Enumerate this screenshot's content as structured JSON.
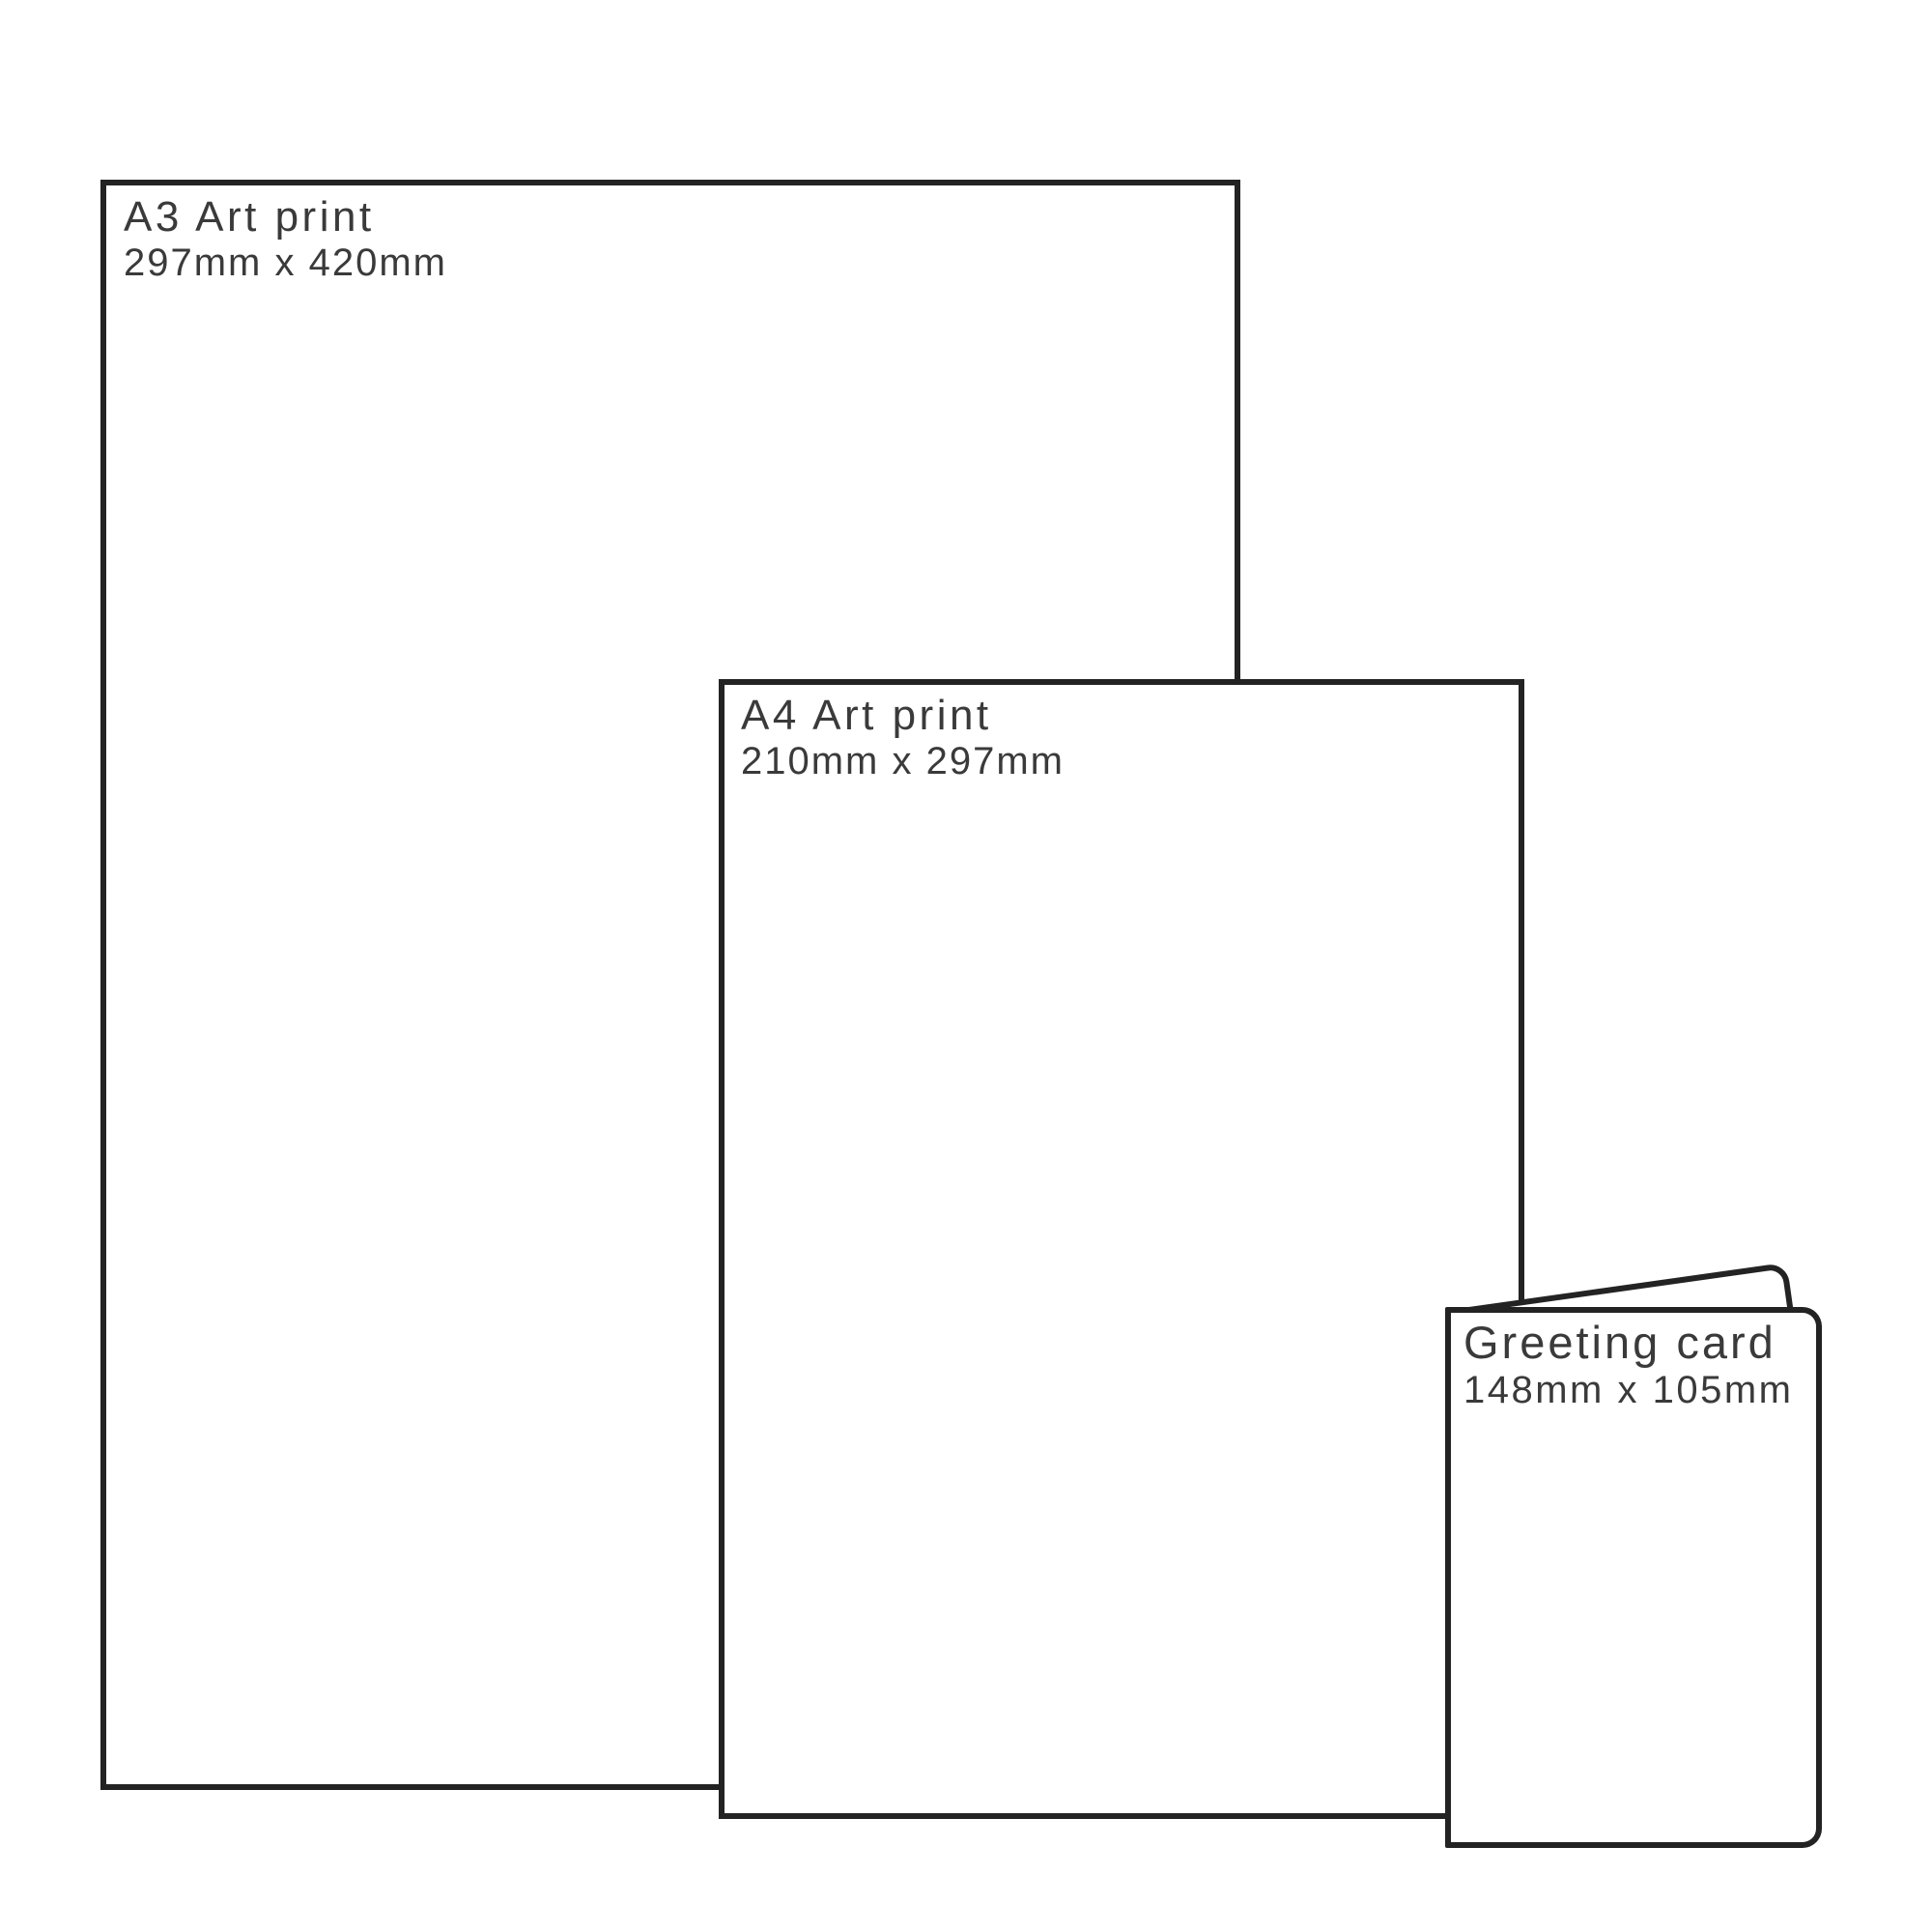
{
  "page": {
    "background": "#ffffff",
    "outline_color": "#232323",
    "text_color": "#3a3a3a"
  },
  "items": [
    {
      "name": "A3 Art print",
      "size": "297mm x 420mm"
    },
    {
      "name": "A4 Art print",
      "size": "210mm x 297mm"
    },
    {
      "name": "Greeting card",
      "size": "148mm x 105mm"
    }
  ]
}
